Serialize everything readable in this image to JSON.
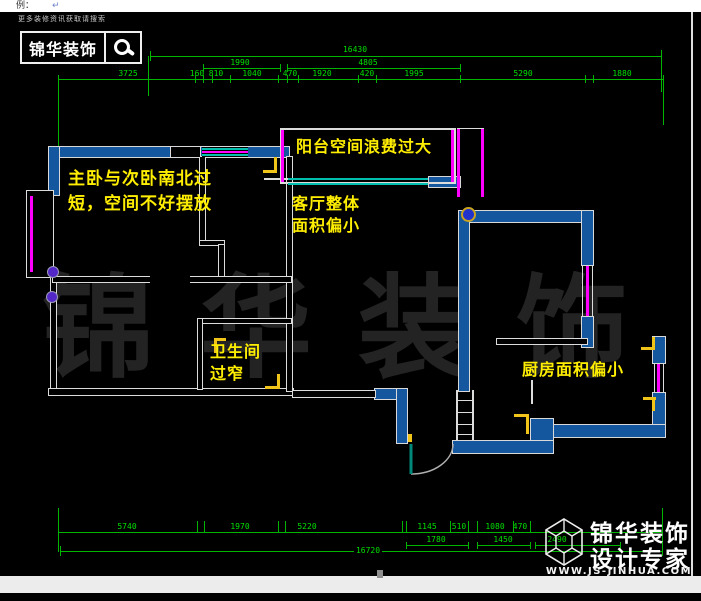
{
  "topbar": {
    "label": "例：",
    "return_glyph": "↵"
  },
  "header": {
    "search_hint": "更多装修资讯获取请搜索",
    "brand": "锦华装饰"
  },
  "watermark": "锦华装饰",
  "notes": {
    "bedroom": [
      "主卧与次卧南北过",
      "短，空间不好摆放"
    ],
    "balcony": "阳台空间浪费过大",
    "living": [
      "客厅整体",
      "面积偏小"
    ],
    "bath": [
      "卫生间",
      "过窄"
    ],
    "kitchen": "厨房面积偏小"
  },
  "dims": {
    "top": {
      "total": "16430",
      "row2": [
        "1990",
        "4805"
      ],
      "row3": [
        "3725",
        "160",
        "810",
        "1040",
        "470",
        "1920",
        "420",
        "1995",
        "5290",
        "1880"
      ]
    },
    "bottom": {
      "row1": [
        "5740",
        "1970",
        "5220",
        "1145",
        "510",
        "1080",
        "470"
      ],
      "row2": [
        "1780",
        "1450",
        "2490"
      ],
      "total": "16720"
    }
  },
  "footer": {
    "brand_line1": "锦华装饰",
    "brand_line2": "设计专家",
    "website": "WWW.JS-JINHUA.COM"
  },
  "colors": {
    "wall_blue": "#15579e",
    "dim_green": "#00b400",
    "note_yellow": "#ffee00",
    "window_magenta": "#ff00ff",
    "window_cyan": "#00bfae",
    "door_frame_yellow": "#f0c419",
    "watermark_gray": "#232323"
  }
}
